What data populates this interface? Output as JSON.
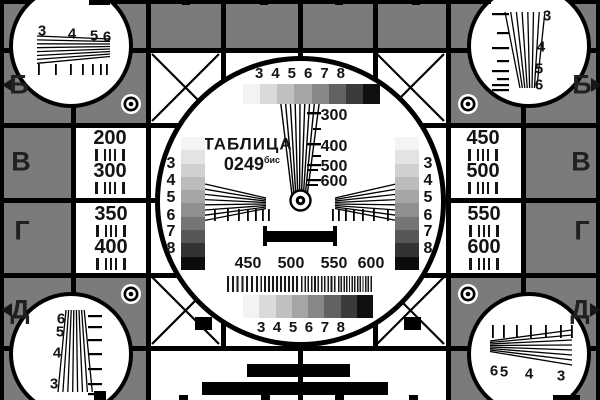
{
  "colors": {
    "background": "#7b7b7b",
    "ink": "#000000",
    "white": "#ffffff"
  },
  "title": {
    "line1": "ТАБЛИЦА",
    "number": "0249",
    "suffix": "бис"
  },
  "rows": {
    "left": [
      "Б",
      "В",
      "Г",
      "Д"
    ],
    "right": [
      "Б",
      "В",
      "Г",
      "Д"
    ]
  },
  "left_panel": [
    "200",
    "300",
    "350",
    "400"
  ],
  "right_panel": [
    "450",
    "500",
    "550",
    "600"
  ],
  "center": {
    "top_gray_labels": [
      "3",
      "4",
      "5",
      "6",
      "7",
      "8"
    ],
    "bottom_gray_labels": [
      "3",
      "4",
      "5",
      "6",
      "7",
      "8"
    ],
    "left_gray_labels": [
      "3",
      "4",
      "5",
      "6",
      "7",
      "8"
    ],
    "right_gray_labels": [
      "3",
      "4",
      "5",
      "6",
      "7",
      "8"
    ],
    "wedge_scale": [
      "300",
      "400",
      "500",
      "600"
    ],
    "burst_labels": [
      "450",
      "500",
      "550",
      "600"
    ]
  },
  "corners": {
    "top_left": [
      "3",
      "4",
      "5",
      "6"
    ],
    "top_right": [
      "3",
      "4",
      "5",
      "6"
    ],
    "bottom_left": [
      "6",
      "5",
      "4",
      "3"
    ],
    "bottom_right": [
      "6",
      "5",
      "4",
      "3"
    ]
  },
  "grayscale": {
    "h_steps": [
      "#f3f3f3",
      "#dadada",
      "#c0c0c0",
      "#a5a5a5",
      "#878787",
      "#626262",
      "#3b3b3b",
      "#101010"
    ],
    "v_steps": [
      "#f4f4f4",
      "#e3e3e3",
      "#d0d0d0",
      "#bcbcbc",
      "#a6a6a6",
      "#8f8f8f",
      "#757575",
      "#575757",
      "#333333",
      "#0c0c0c"
    ]
  }
}
